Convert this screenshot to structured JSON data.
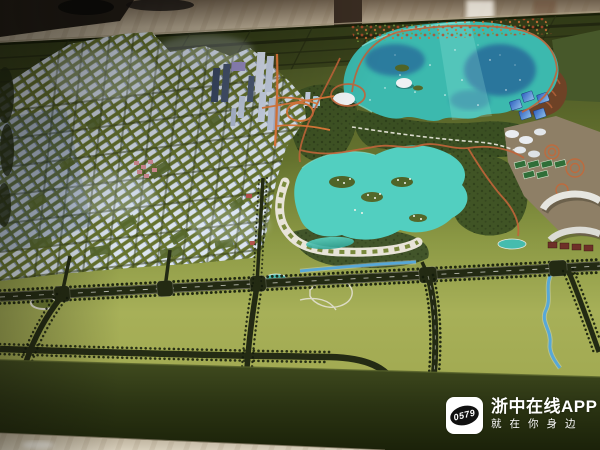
{
  "watermark": {
    "logo_text": "0579",
    "app_name": "浙中在线APP",
    "tagline": "就在你身边"
  },
  "colors": {
    "marble": "#c5b89f",
    "room_dark": "#231d16",
    "table_far": "#47511f",
    "table_near": "#a7b058",
    "table_face": "#2b3413",
    "lake_teal": "#3cb9ae",
    "lake_deep_blue": "#1d3f8f",
    "lagoon_teal": "#52cfc0",
    "park_green": "#3d5123",
    "building_white": "#dbe4f0",
    "road_dark": "#232a13",
    "road_orange": "#c2653a",
    "road_orange_lit": "#e0793a",
    "river_blue": "#57a8d8",
    "watermark_text": "#ffffff"
  }
}
